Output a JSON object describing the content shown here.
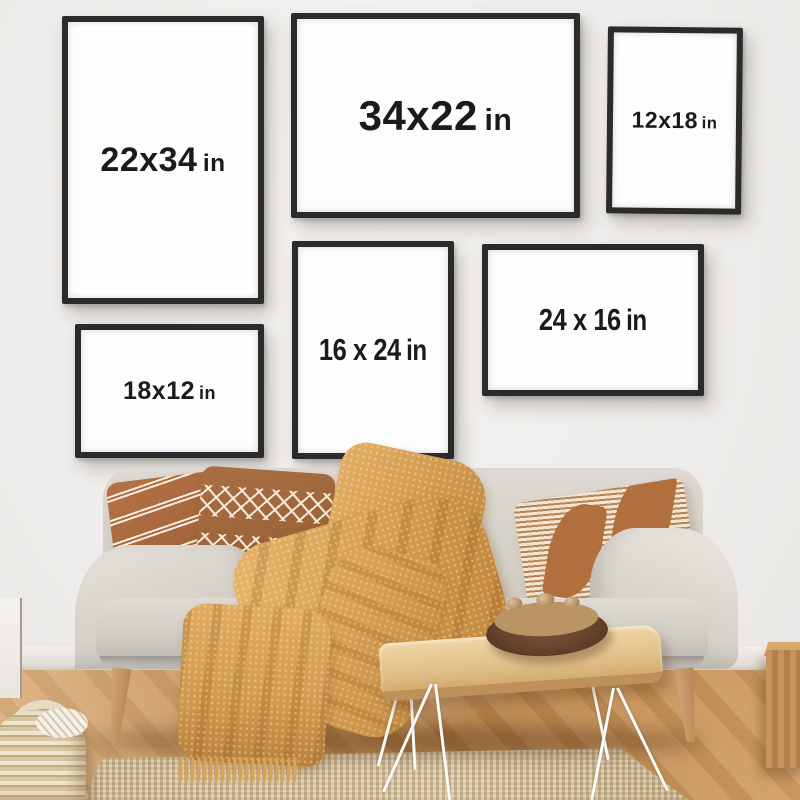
{
  "frames": [
    {
      "name": "frame-22x34",
      "size": "22x34",
      "unit": "in",
      "orientation": "portrait"
    },
    {
      "name": "frame-34x22",
      "size": "34x22",
      "unit": "in",
      "orientation": "landscape"
    },
    {
      "name": "frame-12x18",
      "size": "12x18",
      "unit": "in",
      "orientation": "portrait"
    },
    {
      "name": "frame-18x12",
      "size": "18x12",
      "unit": "in",
      "orientation": "landscape"
    },
    {
      "name": "frame-16x24",
      "size": "16 x 24",
      "unit": "in",
      "orientation": "portrait"
    },
    {
      "name": "frame-24x16",
      "size": "24 x 16",
      "unit": "in",
      "orientation": "landscape"
    }
  ],
  "colors": {
    "wall": "#efedeb",
    "frame_border": "#2b2b2b",
    "frame_mat": "#fdfdfd",
    "label_text": "#1b1b1b",
    "sofa_fabric": "#d6d2ca",
    "pillow_brown": "#a4653a",
    "throw_mustard": "#d7a155",
    "floor_wood": "#c08550",
    "rug_jute": "#d8c3a1",
    "table_wood": "#e0bd86",
    "hairpin_leg": "#faf9f7",
    "bowl_walnut": "#5e3d28",
    "basket_wicker": "#ddcba7"
  }
}
